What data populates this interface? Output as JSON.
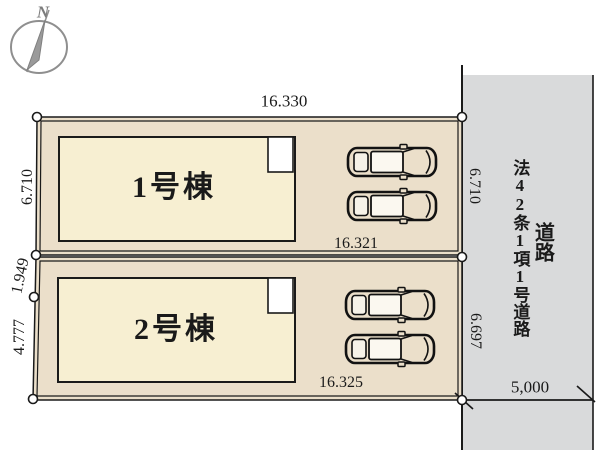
{
  "plan": {
    "compass_label": "N",
    "lot1": {
      "building_label": "1号棟",
      "dim_top": "16.330",
      "dim_bottom": "16.321",
      "dim_left": "6.710",
      "dim_right": "6.710"
    },
    "lot2": {
      "building_label": "2号棟",
      "dim_bottom": "16.325",
      "dim_left_upper": "1.949",
      "dim_left_lower": "4.777",
      "dim_right": "6.697"
    },
    "road": {
      "name": "法42条1項1号道路",
      "label": "道路",
      "width": "5,000"
    },
    "colors": {
      "lot_fill": "#ebdfca",
      "building_fill": "#f7efd2",
      "road_fill": "#d9dadb",
      "line": "#1a1a1a",
      "compass": "#8f8f8f"
    }
  }
}
